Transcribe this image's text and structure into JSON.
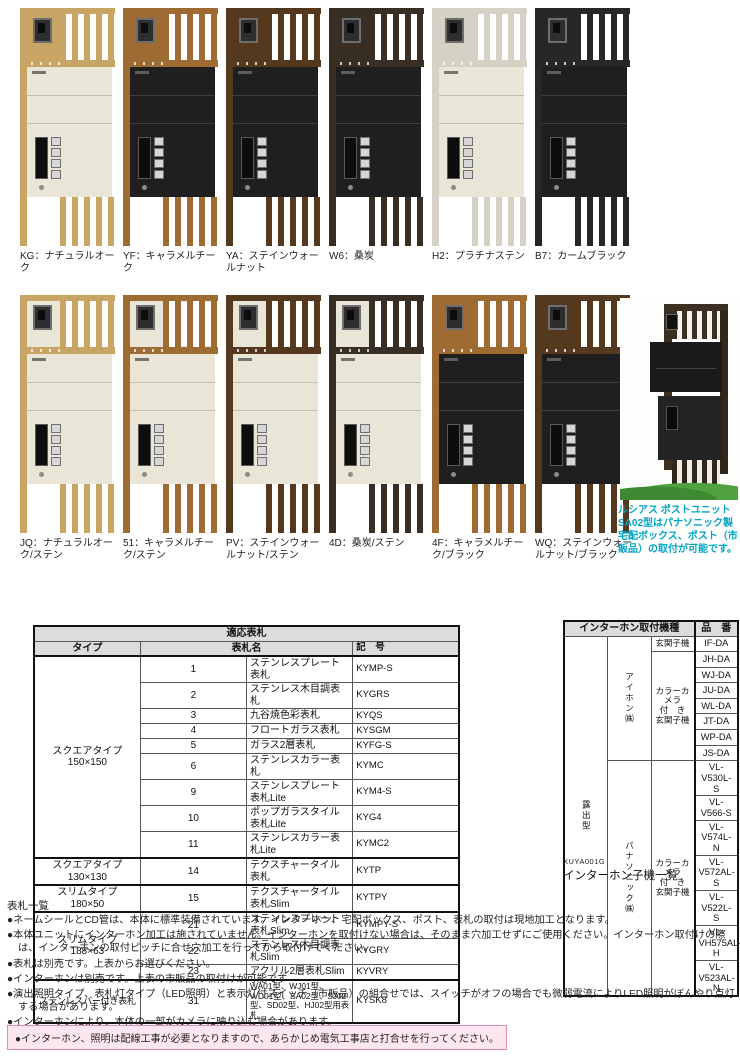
{
  "colors": {
    "natural_oak": "#c9a565",
    "caramel_teak": "#9e6b33",
    "stain_walnut": "#55391f",
    "kuwazumi": "#382e24",
    "platinum_sten": "#d5d1c5",
    "calm_black": "#272727",
    "sten_box": "#eae6d7",
    "black_box": "#1f1f1f",
    "caption_teal": "#00a5c3",
    "warning_bg": "#fce7f0",
    "warning_border": "#e989b1",
    "table_header_bg": "#dcdcdc"
  },
  "products": {
    "row1": [
      {
        "code": "KG",
        "label": "KG：ナチュラルオーク",
        "frame": "#c9a565",
        "box": "#eae6d7",
        "topleft": "frame"
      },
      {
        "code": "YF",
        "label": "YF：キャラメルチーク",
        "frame": "#9e6b33",
        "box": "#1f1f1f",
        "topleft": "frame"
      },
      {
        "code": "YA",
        "label": "YA：ステインウォールナット",
        "frame": "#55391f",
        "box": "#1f1f1f",
        "topleft": "frame"
      },
      {
        "code": "W6",
        "label": "W6：桑炭",
        "frame": "#382e24",
        "box": "#1f1f1f",
        "topleft": "frame"
      },
      {
        "code": "H2",
        "label": "H2：プラチナステン",
        "frame": "#d5d1c5",
        "box": "#eae6d7",
        "topleft": "frame"
      },
      {
        "code": "B7",
        "label": "B7：カームブラック",
        "frame": "#272727",
        "box": "#1f1f1f",
        "topleft": "frame"
      }
    ],
    "row2": [
      {
        "code": "JQ",
        "label": "JQ：ナチュラルオーク/ステン",
        "frame": "#c9a565",
        "box": "#eae6d7",
        "topleft": "box"
      },
      {
        "code": "51",
        "label": "51：キャラメルチーク/ステン",
        "frame": "#9e6b33",
        "box": "#eae6d7",
        "topleft": "box"
      },
      {
        "code": "PV",
        "label": "PV：ステインウォールナット/ステン",
        "frame": "#55391f",
        "box": "#eae6d7",
        "topleft": "box"
      },
      {
        "code": "4D",
        "label": "4D：桑炭/ステン",
        "frame": "#382e24",
        "box": "#eae6d7",
        "topleft": "box"
      },
      {
        "code": "4F",
        "label": "4F：キャラメルチーク/ブラック",
        "frame": "#9e6b33",
        "box": "#1f1f1f",
        "topleft": "frame"
      },
      {
        "code": "WQ",
        "label": "WQ：ステインウォールナット/ブラック",
        "frame": "#55391f",
        "box": "#1f1f1f",
        "topleft": "frame"
      }
    ]
  },
  "photo": {
    "caption": "ルシアス ポストユニット SA02型はパナソニック製宅配ボックス、ポスト（市販品）の取付が可能です。"
  },
  "nameplate": {
    "title": "適応表札",
    "headers": {
      "type": "タイプ",
      "name": "表札名",
      "code": "記　号"
    },
    "groups": [
      {
        "type_lines": [
          "スクエアタイプ",
          "150×150"
        ],
        "tight": false,
        "rows": [
          {
            "no": "1",
            "name": "ステンレスプレート表札",
            "code": "KYMP-S"
          },
          {
            "no": "2",
            "name": "ステンレス木目調表札",
            "code": "KYGRS"
          },
          {
            "no": "3",
            "name": "九谷焼色彩表札",
            "code": "KYQS"
          },
          {
            "no": "4",
            "name": "フロートガラス表札",
            "code": "KYSGM"
          },
          {
            "no": "5",
            "name": "ガラス2層表札",
            "code": "KYFG-S"
          },
          {
            "no": "6",
            "name": "ステンレスカラー表札",
            "code": "KYMC"
          },
          {
            "no": "9",
            "name": "ステンレスプレート表札Lite",
            "code": "KYM4-S"
          },
          {
            "no": "10",
            "name": "ポップガラスタイル表札Lite",
            "code": "KYG4"
          },
          {
            "no": "11",
            "name": "ステンレスカラー表札Lite",
            "code": "KYMC2"
          }
        ]
      },
      {
        "type_lines": [
          "スクエアタイプ",
          "130×130"
        ],
        "tight": false,
        "rows": [
          {
            "no": "14",
            "name": "テクスチャータイル表札",
            "code": "KYTP"
          }
        ]
      },
      {
        "type_lines": [
          "スリムタイプ",
          "180×50"
        ],
        "tight": false,
        "rows": [
          {
            "no": "15",
            "name": "テクスチャータイル表札Slim",
            "code": "KYTPY"
          }
        ]
      },
      {
        "type_lines": [
          "スリムタイプ",
          "188×63"
        ],
        "tight": false,
        "rows": [
          {
            "no": "21",
            "name": "ステンレスプレート表札Slim",
            "code": "KYMPY-S"
          },
          {
            "no": "22",
            "name": "ステンレス木目調表札Slim",
            "code": "KYGRY"
          },
          {
            "no": "23",
            "name": "アクリル2層表札Slim",
            "code": "KYVRY"
          }
        ]
      },
      {
        "type_lines": [
          "ステンレスバー付き表札"
        ],
        "tight": true,
        "rows": [
          {
            "no": "31",
            "name": "WA01型、WJ01型、WD01型、SA02型、SJ02型、SD02型、HJ02型用表札",
            "code": "KYSK8",
            "small": true
          }
        ]
      }
    ],
    "caption": "表札一覧"
  },
  "intercom": {
    "header": "インターホン取付機種",
    "part_header": "品　番",
    "mount": "露出型",
    "makers": [
      {
        "name": "アイホン㈱",
        "groups": [
          {
            "label_lines": [
              "玄関子機"
            ],
            "parts": [
              "IF-DA"
            ]
          },
          {
            "label_lines": [
              "カラーカメラ",
              "付　き",
              "玄関子機"
            ],
            "parts": [
              "JH-DA",
              "WJ-DA",
              "JU-DA",
              "WL-DA",
              "JT-DA",
              "WP-DA",
              "JS-DA"
            ]
          }
        ]
      },
      {
        "name": "パナソニック㈱",
        "groups": [
          {
            "label_lines": [
              "カラーカメラ",
              "付　き",
              "玄関子機"
            ],
            "parts": [
              "VL-V530L-S",
              "VL-V566-S",
              "VL-V574L-N",
              "VL-V572AL-S",
              "VL-V522L-S",
              "VL-VH575AL-H",
              "VL-V523AL-N"
            ]
          }
        ]
      }
    ],
    "code": "XUYA001G",
    "caption": "インターホン子機一覧"
  },
  "notes": {
    "bullets": [
      "●ネームシールとCD管は、本体に標準装備されています。インターホン、宅配ボックス、ポスト、表札の取付は現地加工となります。",
      "●本体ユニットにインターホン加工は施されていません。インターホンを取付けない場合は、そのまま穴加工せずにご使用ください。インターホン取付けの際は、インターホンの取付ピッチに合せ穴加工を行ってから取付けてください。",
      "●表札は別売です。上表からお選びください。",
      "●インターホンは別売です。上表の市販品の取付けが可能です",
      "●演出照明タイプ、表札灯タイプ（LED照明）と表示灯付スイッチ（市販品）の組合せでは、スイッチがオフの場合でも微弱電流によりLED照明がぼんやり点灯する場合があります。",
      "●インターホンにより、本体の一部がカメラに映り込む場合があります。"
    ],
    "warning": "●インターホン、照明は配線工事が必要となりますので、あらかじめ電気工事店と打合せを行ってください。"
  }
}
